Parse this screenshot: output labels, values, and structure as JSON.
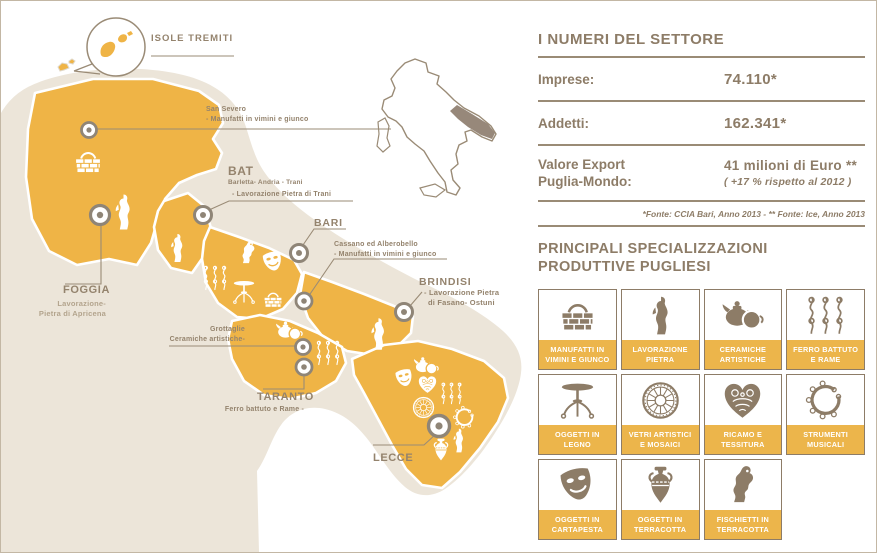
{
  "map": {
    "tremiti": "ISOLE TREMITI",
    "san_severo": {
      "title": "San Severo",
      "desc": "- Manufatti in vimini e giunco"
    },
    "bat": {
      "title": "BAT",
      "subtitle": "Barletta- Andria - Trani",
      "desc": "- Lavorazione Pietra di Trani"
    },
    "bari": {
      "title": "BARI"
    },
    "cassano": {
      "title": "Cassano ed Alberobello",
      "desc": "- Manufatti in vimini e giunco"
    },
    "brindisi": {
      "title": "BRINDISI",
      "desc_line1": "- Lavorazione Pietra",
      "desc_line2": "di Fasano- Ostuni"
    },
    "foggia": {
      "title": "FOGGIA",
      "desc_line1": "Lavorazione-",
      "desc_line2": "Pietra di Apricena"
    },
    "grottaglie": {
      "title": "Grottaglie",
      "desc": "Ceramiche artistiche-"
    },
    "taranto": {
      "title": "TARANTO",
      "desc": "Ferro battuto e Rame -"
    },
    "lecce": {
      "title": "LECCE"
    }
  },
  "stats": {
    "title": "I NUMERI DEL SETTORE",
    "imprese_label": "Imprese:",
    "imprese_value": "74.110*",
    "addetti_label": "Addetti:",
    "addetti_value": "162.341*",
    "export_label_line1": "Valore Export",
    "export_label_line2": "Puglia-Mondo:",
    "export_value": "41 milioni di Euro **",
    "export_note": "( +17 % rispetto al 2012 )",
    "source": "*Fonte: CCIA Bari, Anno 2013 - ** Fonte: Ice, Anno 2013"
  },
  "specializations": {
    "title_line1": "PRINCIPALI SPECIALIZZAZIONI",
    "title_line2": "PRODUTTIVE PUGLIESI",
    "items": [
      {
        "icon": "basket",
        "label_line1": "MANUFATTI IN",
        "label_line2": "VIMINI E GIUNCO"
      },
      {
        "icon": "statue",
        "label_line1": "LAVORAZIONE",
        "label_line2": "PIETRA"
      },
      {
        "icon": "teapot",
        "label_line1": "CERAMICHE",
        "label_line2": "ARTISTICHE"
      },
      {
        "icon": "iron",
        "label_line1": "FERRO BATTUTO",
        "label_line2": "E RAME"
      },
      {
        "icon": "table",
        "label_line1": "OGGETTI IN",
        "label_line2": "LEGNO"
      },
      {
        "icon": "rosette",
        "label_line1": "VETRI ARTISTICI",
        "label_line2": "E MOSAICI"
      },
      {
        "icon": "heart",
        "label_line1": "RICAMO E",
        "label_line2": "TESSITURA"
      },
      {
        "icon": "tambourine",
        "label_line1": "STRUMENTI",
        "label_line2": "MUSICALI"
      },
      {
        "icon": "mask",
        "label_line1": "OGGETTI IN",
        "label_line2": "CARTAPESTA"
      },
      {
        "icon": "amphora",
        "label_line1": "OGGETTI IN",
        "label_line2": "TERRACOTTA"
      },
      {
        "icon": "whistle",
        "label_line1": "FISCHIETTI IN",
        "label_line2": "TERRACOTTA"
      }
    ]
  },
  "colors": {
    "yellow": "#efb446",
    "label_band": "#ecb54b",
    "taupe_text": "#8d7c67",
    "line": "#9a8b76",
    "beige_land": "#ece5d9",
    "pin": "#8f8577"
  }
}
